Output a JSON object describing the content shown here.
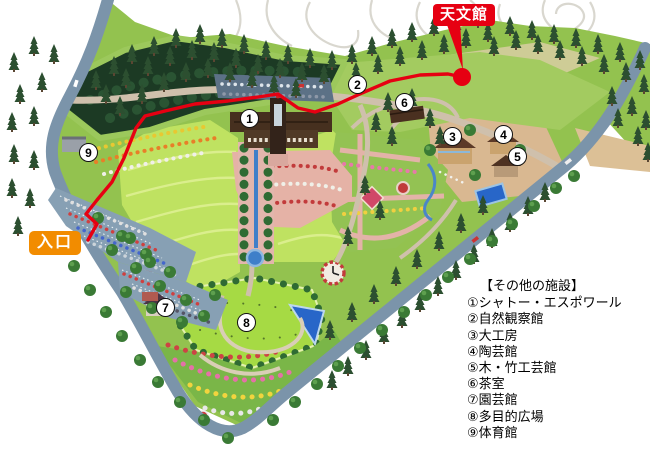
{
  "labels": {
    "tenmonkan": "天文館",
    "entrance": "入口"
  },
  "map_markers": [
    "1",
    "2",
    "3",
    "4",
    "5",
    "6",
    "7",
    "8",
    "9"
  ],
  "legend": {
    "title": "【その他の施設】",
    "items": [
      {
        "num": "①",
        "label": "シャトー・エスポワール"
      },
      {
        "num": "②",
        "label": "自然観察館"
      },
      {
        "num": "③",
        "label": "大工房"
      },
      {
        "num": "④",
        "label": "陶芸館"
      },
      {
        "num": "⑤",
        "label": "木・竹工芸館"
      },
      {
        "num": "⑥",
        "label": "茶室"
      },
      {
        "num": "⑦",
        "label": "園芸館"
      },
      {
        "num": "⑧",
        "label": "多目的広場"
      },
      {
        "num": "⑨",
        "label": "体育館"
      }
    ]
  },
  "colors": {
    "tenmonkan_bg": "#e60012",
    "entrance_bg": "#f28c00",
    "route": "#e60012",
    "road": "#7b94aa",
    "lawn": "#bfe261",
    "forest": "#1c3a24"
  }
}
